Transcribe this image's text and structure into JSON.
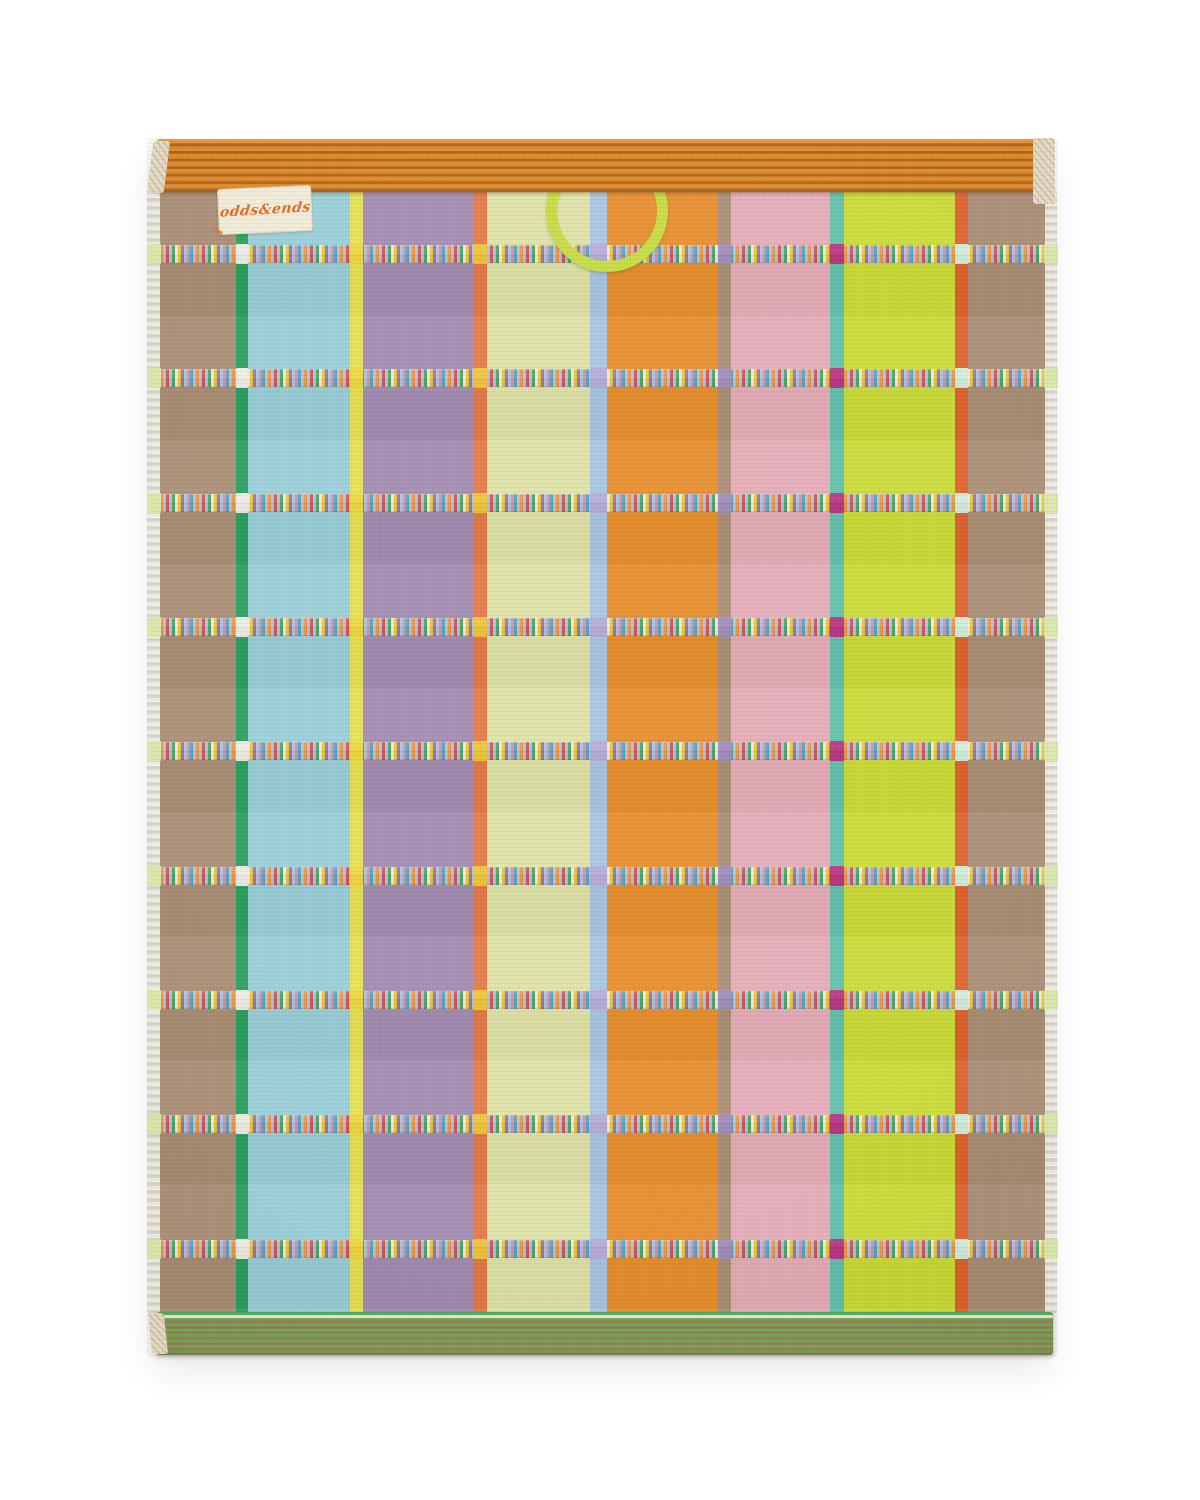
{
  "page": {
    "background": "#ffffff"
  },
  "towel": {
    "description": "striped-terry-towel-product-photo",
    "label": {
      "text": "odds&ends",
      "bg_color": "#f4eeda",
      "text_color": "#e2661c"
    },
    "top_band": {
      "base_color": "#e0871d",
      "stripe_color": "#b25f14"
    },
    "bottom_band": {
      "base_color": "#6fa04d",
      "stripe_color": "#8d7a4a",
      "top_line": "#ece8cc",
      "edge_green": "#49a85c"
    },
    "loop": {
      "color": "#c6dc3c"
    },
    "selvedge": {
      "color_a": "#d8d4c9",
      "color_b": "#f1efe8"
    },
    "corner_fold_color": "#e9dfc9",
    "stripes": [
      {
        "name": "taupe-left",
        "color": "#a5876b",
        "width_px": 76
      },
      {
        "name": "green",
        "color": "#189b52",
        "width_px": 12
      },
      {
        "name": "sky-blue",
        "color": "#93cdd8",
        "width_px": 102
      },
      {
        "name": "yellow",
        "color": "#e7e24a",
        "width_px": 13
      },
      {
        "name": "purple",
        "color": "#9d85ae",
        "width_px": 110
      },
      {
        "name": "vermilion",
        "color": "#e4703a",
        "width_px": 14
      },
      {
        "name": "pale-yellow",
        "color": "#dfe3a2",
        "width_px": 103
      },
      {
        "name": "periwinkle",
        "color": "#a3c3e2",
        "width_px": 17
      },
      {
        "name": "orange",
        "color": "#e8871d",
        "width_px": 111
      },
      {
        "name": "taupe-mid",
        "color": "#a5876b",
        "width_px": 13
      },
      {
        "name": "pink",
        "color": "#e5a8b5",
        "width_px": 99
      },
      {
        "name": "teal",
        "color": "#56bfa8",
        "width_px": 14
      },
      {
        "name": "chartreuse",
        "color": "#c9db28",
        "width_px": 111
      },
      {
        "name": "vermilion-right",
        "color": "#e0561f",
        "width_px": 13
      },
      {
        "name": "taupe-right",
        "color": "#a5876b",
        "width_px": 77
      }
    ],
    "stitch_rows": {
      "count": 9,
      "height_px": 18,
      "offsets_px": [
        53,
        177,
        302,
        426,
        550,
        675,
        799,
        923,
        1048
      ],
      "palette": [
        "#e98f3e",
        "#a9bfdd",
        "#d04a4a",
        "#a9bfdd",
        "#3fa05c",
        "#f0e8d8",
        "#e8c22e",
        "#8f6fa8",
        "#a9bfdd",
        "#e08898",
        "#46a0c8",
        "#c4bcae"
      ],
      "accents": [
        {
          "name": "selvedge-left",
          "pos_px": -13,
          "width_px": 14,
          "color": "#dce9a8"
        },
        {
          "name": "green-cross",
          "pos_px": 76,
          "width_px": 12,
          "color": "#f0ede6"
        },
        {
          "name": "yellow-cross",
          "pos_px": 190,
          "width_px": 13,
          "color": "#eed832"
        },
        {
          "name": "vermilion-cross",
          "pos_px": 313,
          "width_px": 14,
          "color": "#f2c22c"
        },
        {
          "name": "periwinkle-cross",
          "pos_px": 430,
          "width_px": 17,
          "color": "#b2a9d8"
        },
        {
          "name": "taupe-cross",
          "pos_px": 558,
          "width_px": 13,
          "color": "#9b87b8"
        },
        {
          "name": "teal-cross",
          "pos_px": 670,
          "width_px": 14,
          "color": "#b52878"
        },
        {
          "name": "vermilion2-cross",
          "pos_px": 795,
          "width_px": 13,
          "color": "#cfeeda"
        },
        {
          "name": "selvedge-right",
          "pos_px": 884,
          "width_px": 14,
          "color": "#dce9a8"
        }
      ]
    }
  }
}
